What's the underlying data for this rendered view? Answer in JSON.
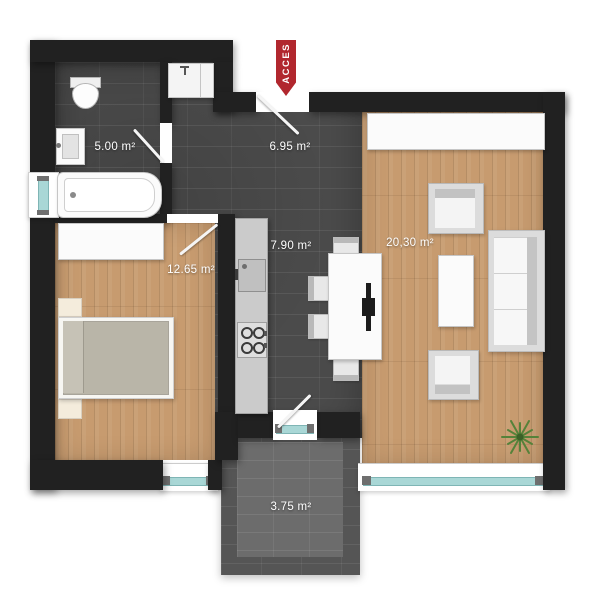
{
  "access": {
    "label": "ACCES",
    "banner_color": "#b1272e"
  },
  "rooms": {
    "bathroom": {
      "name": "bathroom",
      "area": "5.00 m²"
    },
    "hallway": {
      "name": "hallway",
      "area": "6.95 m²"
    },
    "kitchen": {
      "name": "kitchen",
      "area": "7.90 m²"
    },
    "bedroom": {
      "name": "bedroom",
      "area": "12.65 m²"
    },
    "living_room": {
      "name": "living room",
      "area": "20,30 m²"
    },
    "balcony": {
      "name": "balcony",
      "area": "3.75 m²"
    }
  },
  "fixtures": [
    "toilet",
    "bathroom-sink",
    "bathtub",
    "hallway-closet",
    "kitchen-counter",
    "kitchen-sink-unit",
    "stove-4-burners",
    "dining-table",
    "dining-chair-top",
    "dining-chair-bottom",
    "dining-chair-left-1",
    "dining-chair-left-2",
    "sideboard",
    "armchair-top",
    "armchair-bottom",
    "coffee-table",
    "sofa",
    "plant",
    "wardrobe",
    "double-bed",
    "nightstand-top",
    "nightstand-bottom",
    "window-bathroom",
    "window-bedroom",
    "window-living-room",
    "balcony-door",
    "entry-door",
    "bathroom-door",
    "bedroom-door"
  ],
  "colors": {
    "wall": "#212121",
    "tile_floor": "#4b4b4b",
    "wood_floor": "#c79b6f",
    "balcony_floor": "#555555",
    "window_glass": "#a9d7d6",
    "access_red": "#b1272e",
    "plant_green": "#55823a",
    "label_text": "#ffffff"
  }
}
